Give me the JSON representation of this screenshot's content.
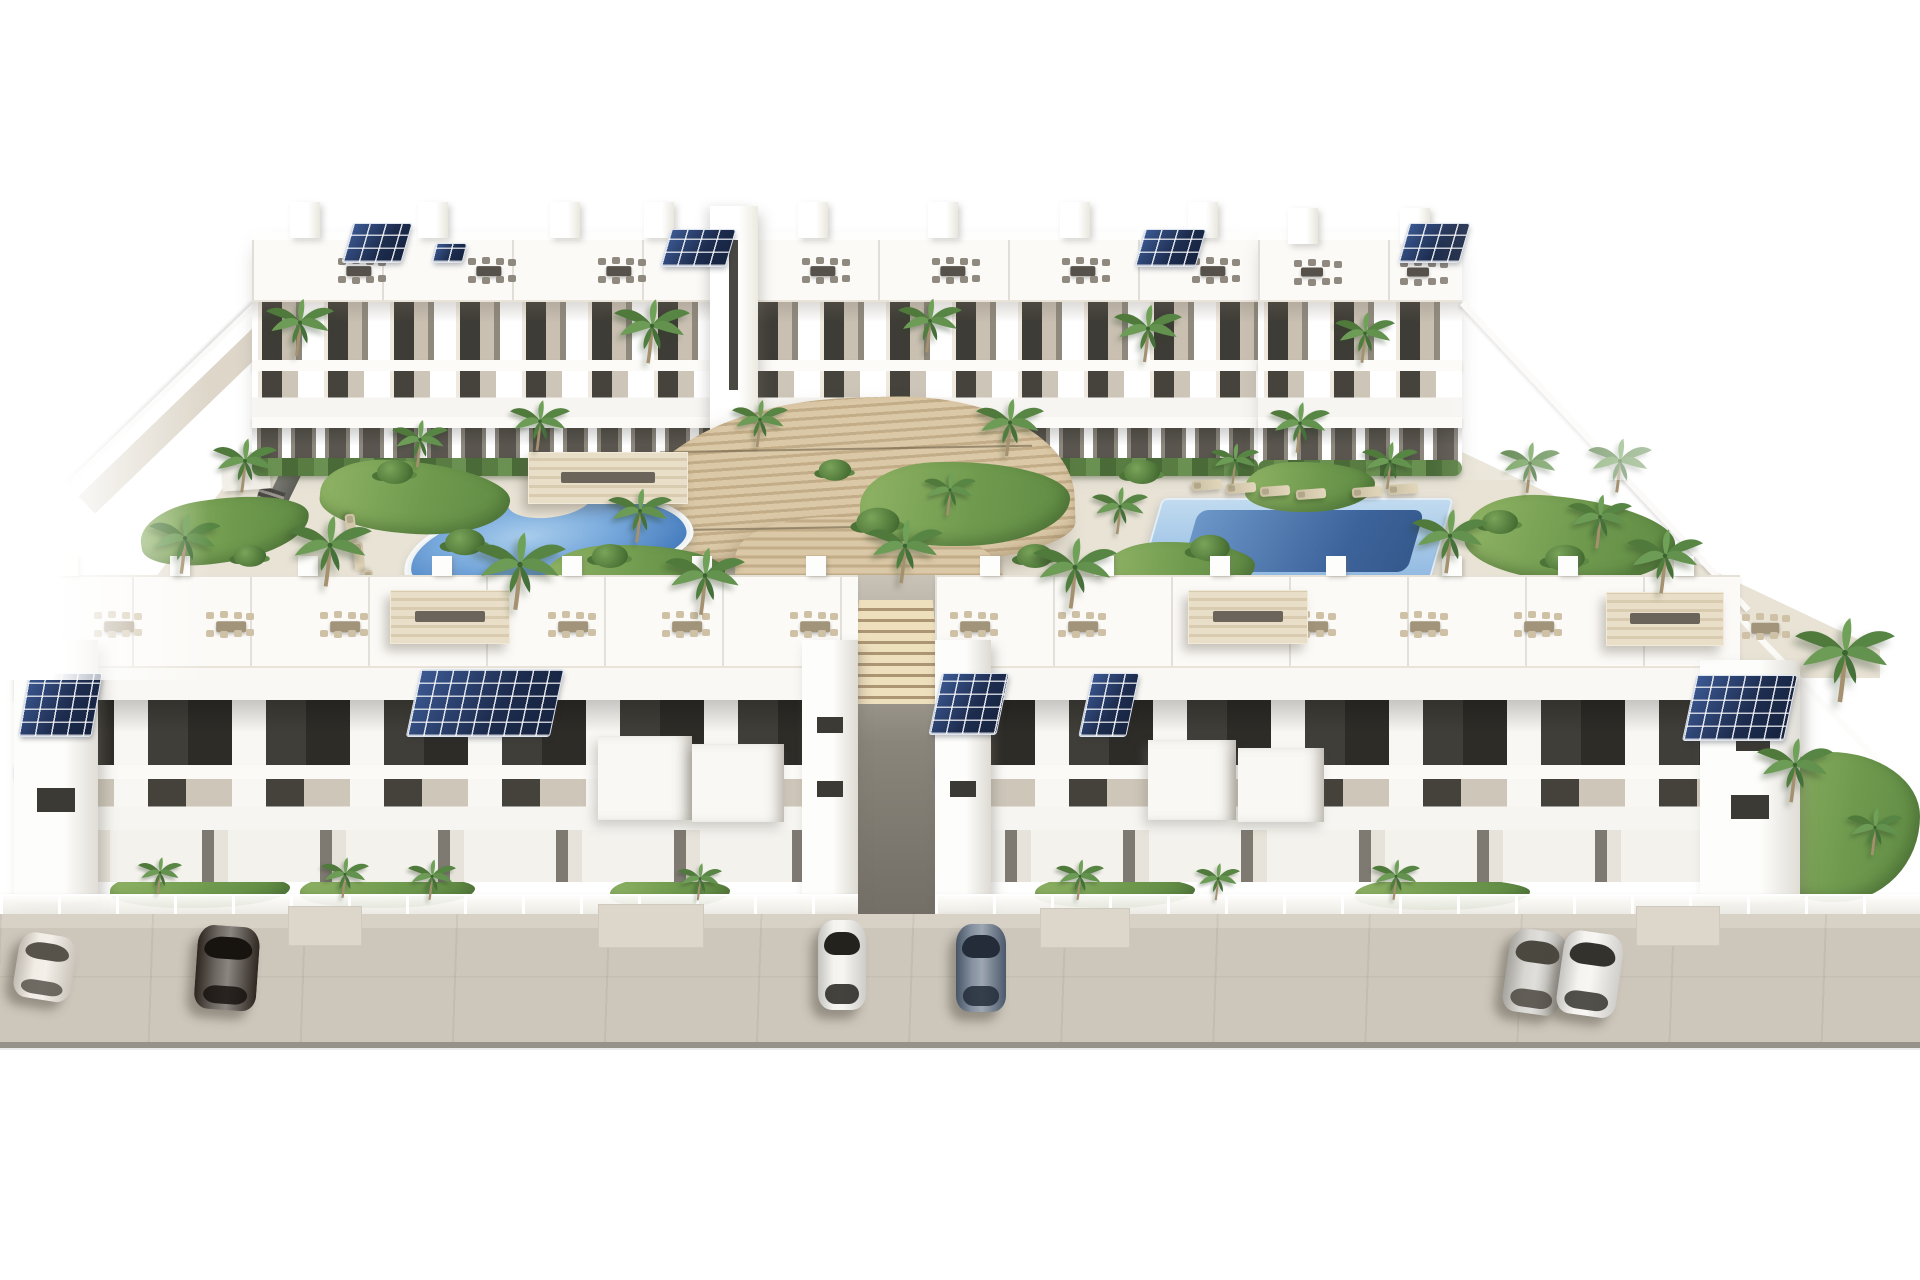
{
  "scene": {
    "description": "Aerial 3D architectural rendering of a white residential apartment complex: two rows of flat-roofed buildings with rooftop terraces, outdoor dining sets and solar panels, a kidney-shaped pool on the left, a rectangular pool on the right, a curved wooden amphitheater stair deck in the center courtyard, palm trees and lawns, and six cars parked on the beige street in front",
    "type": "3D render, no text",
    "width": 1920,
    "height": 1280,
    "background": "#ffffff"
  },
  "palette": {
    "building_white": "#f7f5f1",
    "roof_white": "#fcfbf8",
    "shadow_beige": "#d9d4ca",
    "window_dark": "#3a3833",
    "pool_water_light": "#a9cdec",
    "pool_water_deep": "#3f70ad",
    "pool_inner_dark": "#35598c",
    "deck_wood": "#d3bf9d",
    "deck_wood_dark": "#b49e7a",
    "street": "#cdc6bb",
    "street_edge": "#979289",
    "grass": "#6f9a4e",
    "palm_green": "#5d8a44",
    "solar_navy": "#24365c",
    "furniture_dark": "#56514b",
    "furniture_beige": "#c3b596",
    "canopy_beige": "#e4d9c2"
  },
  "counts": {
    "building_rows": 2,
    "swimming_pools": 2,
    "parked_cars": 6,
    "solar_arrays": 10
  },
  "objects": {
    "cars": [
      {
        "x": 16,
        "y": 934,
        "w": 58,
        "h": 66,
        "r": 9,
        "c": "#ece5da",
        "g": "#57524a"
      },
      {
        "x": 196,
        "y": 926,
        "w": 62,
        "h": 84,
        "r": 4,
        "c": "#372e26",
        "g": "#17130f"
      },
      {
        "x": 818,
        "y": 920,
        "w": 48,
        "h": 90,
        "r": 0,
        "c": "#efeee9",
        "g": "#24221d"
      },
      {
        "x": 956,
        "y": 924,
        "w": 50,
        "h": 88,
        "r": 0,
        "c": "#57677c",
        "g": "#232c38"
      },
      {
        "x": 1506,
        "y": 930,
        "w": 58,
        "h": 84,
        "r": 8,
        "c": "#cac7c1",
        "g": "#4b4840"
      },
      {
        "x": 1560,
        "y": 932,
        "w": 60,
        "h": 84,
        "r": 8,
        "c": "#f2f0eb",
        "g": "#34322d"
      }
    ],
    "palms": [
      {
        "x": 300,
        "y": 332,
        "s": 0.85
      },
      {
        "x": 652,
        "y": 336,
        "s": 0.95
      },
      {
        "x": 930,
        "y": 330,
        "s": 0.8
      },
      {
        "x": 1148,
        "y": 338,
        "s": 0.85
      },
      {
        "x": 1365,
        "y": 342,
        "s": 0.75
      },
      {
        "x": 245,
        "y": 470,
        "s": 0.8
      },
      {
        "x": 420,
        "y": 448,
        "s": 0.7
      },
      {
        "x": 540,
        "y": 430,
        "s": 0.75
      },
      {
        "x": 760,
        "y": 428,
        "s": 0.7
      },
      {
        "x": 1010,
        "y": 432,
        "s": 0.85
      },
      {
        "x": 1300,
        "y": 432,
        "s": 0.75
      },
      {
        "x": 1620,
        "y": 470,
        "s": 0.8
      },
      {
        "x": 185,
        "y": 548,
        "s": 0.9
      },
      {
        "x": 330,
        "y": 556,
        "s": 1.05
      },
      {
        "x": 520,
        "y": 576,
        "s": 1.15
      },
      {
        "x": 640,
        "y": 520,
        "s": 0.8
      },
      {
        "x": 705,
        "y": 586,
        "s": 1.0
      },
      {
        "x": 905,
        "y": 556,
        "s": 0.95
      },
      {
        "x": 950,
        "y": 498,
        "s": 0.65
      },
      {
        "x": 1075,
        "y": 578,
        "s": 1.05
      },
      {
        "x": 1120,
        "y": 515,
        "s": 0.7
      },
      {
        "x": 1235,
        "y": 468,
        "s": 0.6
      },
      {
        "x": 1390,
        "y": 470,
        "s": 0.7
      },
      {
        "x": 1450,
        "y": 546,
        "s": 0.95
      },
      {
        "x": 1530,
        "y": 472,
        "s": 0.75
      },
      {
        "x": 1600,
        "y": 526,
        "s": 0.8
      },
      {
        "x": 1665,
        "y": 566,
        "s": 0.95
      },
      {
        "x": 160,
        "y": 880,
        "s": 0.55
      },
      {
        "x": 345,
        "y": 882,
        "s": 0.6
      },
      {
        "x": 432,
        "y": 884,
        "s": 0.6
      },
      {
        "x": 700,
        "y": 886,
        "s": 0.55
      },
      {
        "x": 1080,
        "y": 884,
        "s": 0.6
      },
      {
        "x": 1218,
        "y": 886,
        "s": 0.55
      },
      {
        "x": 1396,
        "y": 884,
        "s": 0.6
      },
      {
        "x": 1845,
        "y": 665,
        "s": 1.25
      },
      {
        "x": 1795,
        "y": 775,
        "s": 0.95
      },
      {
        "x": 1875,
        "y": 836,
        "s": 0.7
      }
    ],
    "shrubs": [
      {
        "x": 395,
        "y": 472,
        "s": 1
      },
      {
        "x": 465,
        "y": 542,
        "s": 1.1
      },
      {
        "x": 610,
        "y": 556,
        "s": 1
      },
      {
        "x": 878,
        "y": 522,
        "s": 1.2
      },
      {
        "x": 1142,
        "y": 472,
        "s": 1
      },
      {
        "x": 1210,
        "y": 548,
        "s": 1.1
      },
      {
        "x": 1500,
        "y": 522,
        "s": 1
      },
      {
        "x": 1565,
        "y": 558,
        "s": 1.1
      },
      {
        "x": 250,
        "y": 556,
        "s": 0.9
      },
      {
        "x": 1680,
        "y": 588,
        "s": 1
      },
      {
        "x": 835,
        "y": 470,
        "s": 0.9
      },
      {
        "x": 1035,
        "y": 556,
        "s": 1
      }
    ],
    "lawns": [
      {
        "x": 140,
        "y": 498,
        "w": 170,
        "h": 64,
        "r": -8
      },
      {
        "x": 320,
        "y": 462,
        "w": 190,
        "h": 72,
        "r": 5
      },
      {
        "x": 545,
        "y": 545,
        "w": 180,
        "h": 62,
        "r": 0
      },
      {
        "x": 860,
        "y": 462,
        "w": 210,
        "h": 84,
        "r": 0
      },
      {
        "x": 1105,
        "y": 542,
        "w": 150,
        "h": 54,
        "r": 0
      },
      {
        "x": 1465,
        "y": 498,
        "w": 210,
        "h": 84,
        "r": 6
      },
      {
        "x": 1245,
        "y": 462,
        "w": 130,
        "h": 50,
        "r": 0
      },
      {
        "x": 110,
        "y": 872,
        "w": 180,
        "h": 36,
        "r": 0
      },
      {
        "x": 300,
        "y": 874,
        "w": 175,
        "h": 34,
        "r": 0
      },
      {
        "x": 610,
        "y": 878,
        "w": 120,
        "h": 30,
        "r": 0
      },
      {
        "x": 1035,
        "y": 876,
        "w": 160,
        "h": 32,
        "r": 0
      },
      {
        "x": 1355,
        "y": 878,
        "w": 175,
        "h": 32,
        "r": 0
      },
      {
        "x": 1762,
        "y": 752,
        "w": 158,
        "h": 150,
        "r": 0
      }
    ],
    "solar_arrays": [
      {
        "x": 348,
        "y": 224,
        "w": 58,
        "h": 38,
        "sk": -16
      },
      {
        "x": 434,
        "y": 244,
        "w": 30,
        "h": 18,
        "sk": -14
      },
      {
        "x": 666,
        "y": 230,
        "w": 64,
        "h": 36,
        "sk": -16
      },
      {
        "x": 1140,
        "y": 230,
        "w": 60,
        "h": 36,
        "sk": -16
      },
      {
        "x": 1404,
        "y": 224,
        "w": 60,
        "h": 38,
        "sk": -16
      },
      {
        "x": 24,
        "y": 674,
        "w": 72,
        "h": 62,
        "sk": -10
      },
      {
        "x": 414,
        "y": 670,
        "w": 142,
        "h": 66,
        "sk": -12
      },
      {
        "x": 936,
        "y": 674,
        "w": 66,
        "h": 60,
        "sk": -12
      },
      {
        "x": 1086,
        "y": 674,
        "w": 46,
        "h": 62,
        "sk": -12
      },
      {
        "x": 1690,
        "y": 676,
        "w": 100,
        "h": 64,
        "sk": -12
      }
    ],
    "roof_furniture": [
      {
        "x": 336,
        "y": 258,
        "w": 46,
        "h": 26,
        "t": "#56514b",
        "ch": "#8f897f"
      },
      {
        "x": 466,
        "y": 258,
        "w": 46,
        "h": 26,
        "t": "#56514b",
        "ch": "#8f897f"
      },
      {
        "x": 596,
        "y": 258,
        "w": 46,
        "h": 26,
        "t": "#56514b",
        "ch": "#8f897f"
      },
      {
        "x": 800,
        "y": 258,
        "w": 46,
        "h": 26,
        "t": "#56514b",
        "ch": "#8f897f"
      },
      {
        "x": 930,
        "y": 258,
        "w": 46,
        "h": 26,
        "t": "#56514b",
        "ch": "#8f897f"
      },
      {
        "x": 1060,
        "y": 258,
        "w": 46,
        "h": 26,
        "t": "#56514b",
        "ch": "#8f897f"
      },
      {
        "x": 1190,
        "y": 258,
        "w": 46,
        "h": 26,
        "t": "#56514b",
        "ch": "#8f897f"
      },
      {
        "x": 1292,
        "y": 260,
        "w": 40,
        "h": 24,
        "t": "#56514b",
        "ch": "#8f897f"
      },
      {
        "x": 1398,
        "y": 260,
        "w": 40,
        "h": 24,
        "t": "#56514b",
        "ch": "#8f897f"
      },
      {
        "x": 92,
        "y": 612,
        "w": 54,
        "h": 30,
        "t": "#a2947a",
        "ch": "#cec1a6"
      },
      {
        "x": 204,
        "y": 612,
        "w": 54,
        "h": 30,
        "t": "#a2947a",
        "ch": "#cec1a6"
      },
      {
        "x": 318,
        "y": 612,
        "w": 54,
        "h": 30,
        "t": "#a2947a",
        "ch": "#cec1a6"
      },
      {
        "x": 546,
        "y": 612,
        "w": 54,
        "h": 30,
        "t": "#a2947a",
        "ch": "#cec1a6"
      },
      {
        "x": 660,
        "y": 612,
        "w": 54,
        "h": 30,
        "t": "#a2947a",
        "ch": "#cec1a6"
      },
      {
        "x": 788,
        "y": 612,
        "w": 54,
        "h": 30,
        "t": "#a2947a",
        "ch": "#cec1a6"
      },
      {
        "x": 948,
        "y": 612,
        "w": 54,
        "h": 30,
        "t": "#a2947a",
        "ch": "#cec1a6"
      },
      {
        "x": 1056,
        "y": 612,
        "w": 54,
        "h": 30,
        "t": "#a2947a",
        "ch": "#cec1a6"
      },
      {
        "x": 1286,
        "y": 612,
        "w": 54,
        "h": 30,
        "t": "#a2947a",
        "ch": "#cec1a6"
      },
      {
        "x": 1398,
        "y": 612,
        "w": 54,
        "h": 30,
        "t": "#a2947a",
        "ch": "#cec1a6"
      },
      {
        "x": 1512,
        "y": 612,
        "w": 54,
        "h": 30,
        "t": "#a2947a",
        "ch": "#cec1a6"
      },
      {
        "x": 1740,
        "y": 614,
        "w": 50,
        "h": 28,
        "t": "#a2947a",
        "ch": "#cec1a6"
      }
    ],
    "pergolas": [
      {
        "x": 390,
        "y": 590,
        "w": 120,
        "h": 54
      },
      {
        "x": 1188,
        "y": 590,
        "w": 120,
        "h": 54
      },
      {
        "x": 1606,
        "y": 592,
        "w": 118,
        "h": 54
      },
      {
        "x": 528,
        "y": 452,
        "w": 160,
        "h": 52
      }
    ],
    "loungers": [
      {
        "x": 1192,
        "y": 480,
        "r": -4
      },
      {
        "x": 1226,
        "y": 483,
        "r": -4
      },
      {
        "x": 1260,
        "y": 486,
        "r": -4
      },
      {
        "x": 1296,
        "y": 489,
        "r": -4
      },
      {
        "x": 1352,
        "y": 487,
        "r": -4
      },
      {
        "x": 1388,
        "y": 484,
        "r": -4
      },
      {
        "x": 336,
        "y": 524,
        "r": 84
      },
      {
        "x": 344,
        "y": 552,
        "r": 84
      },
      {
        "x": 354,
        "y": 580,
        "r": 84
      },
      {
        "x": 618,
        "y": 482,
        "r": -6
      },
      {
        "x": 648,
        "y": 486,
        "r": -6
      }
    ],
    "chimneys": [
      {
        "x": 58,
        "y": 556
      },
      {
        "x": 170,
        "y": 556
      },
      {
        "x": 298,
        "y": 556
      },
      {
        "x": 432,
        "y": 556
      },
      {
        "x": 562,
        "y": 556
      },
      {
        "x": 692,
        "y": 556
      },
      {
        "x": 806,
        "y": 556
      },
      {
        "x": 980,
        "y": 556
      },
      {
        "x": 1094,
        "y": 556
      },
      {
        "x": 1210,
        "y": 556
      },
      {
        "x": 1326,
        "y": 556
      },
      {
        "x": 1442,
        "y": 556
      },
      {
        "x": 1558,
        "y": 556
      },
      {
        "x": 1674,
        "y": 556
      }
    ],
    "roof_towers": [
      {
        "x": 290,
        "y": 202
      },
      {
        "x": 418,
        "y": 202
      },
      {
        "x": 550,
        "y": 202
      },
      {
        "x": 644,
        "y": 202
      },
      {
        "x": 798,
        "y": 202
      },
      {
        "x": 928,
        "y": 202
      },
      {
        "x": 1060,
        "y": 202
      },
      {
        "x": 1188,
        "y": 202
      },
      {
        "x": 1288,
        "y": 208
      },
      {
        "x": 1400,
        "y": 208
      }
    ],
    "white_cubes": [
      {
        "x": 598,
        "y": 736,
        "w": 94,
        "h": 84
      },
      {
        "x": 692,
        "y": 744,
        "w": 92,
        "h": 78
      },
      {
        "x": 1148,
        "y": 740,
        "w": 88,
        "h": 80
      },
      {
        "x": 1238,
        "y": 748,
        "w": 86,
        "h": 74
      }
    ],
    "driveway_aprons": [
      {
        "x": 288,
        "y": 906,
        "w": 74,
        "h": 40
      },
      {
        "x": 598,
        "y": 904,
        "w": 106,
        "h": 44
      },
      {
        "x": 1040,
        "y": 908,
        "w": 90,
        "h": 40
      },
      {
        "x": 1636,
        "y": 906,
        "w": 84,
        "h": 40
      }
    ],
    "hedges": [
      {
        "x": 252,
        "y": 458,
        "w": 466,
        "h": 18
      },
      {
        "x": 748,
        "y": 458,
        "w": 510,
        "h": 18
      },
      {
        "x": 1258,
        "y": 460,
        "w": 204,
        "h": 16
      }
    ]
  }
}
